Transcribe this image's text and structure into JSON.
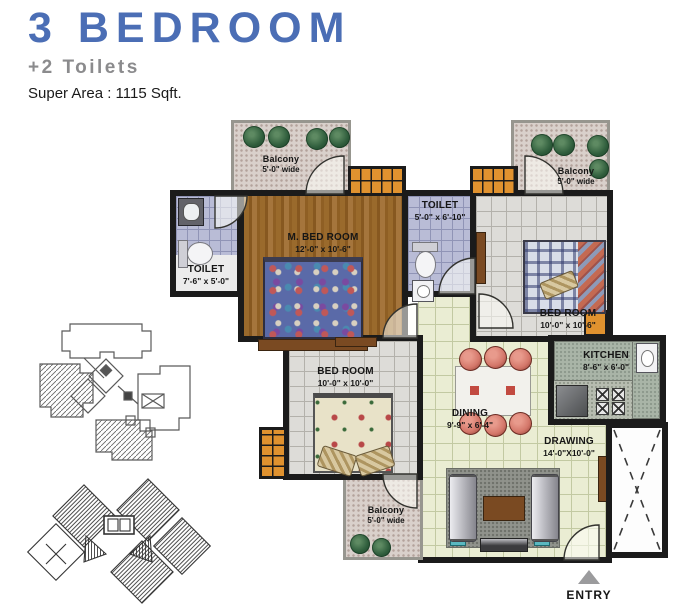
{
  "header": {
    "title": "3 BEDROOM",
    "subtitle": "+2 Toilets",
    "super_area": "Super Area : 1115 Sqft."
  },
  "rooms": {
    "balcony_tl": {
      "name": "Balcony",
      "dim": "5'-0\" wide"
    },
    "m_bedroom": {
      "name": "M. BED ROOM",
      "dim": "12'-0\" x 10'-6\""
    },
    "toilet_left": {
      "name": "TOILET",
      "dim": "7'-6\" x 5'-0\""
    },
    "toilet_mid": {
      "name": "TOILET",
      "dim": "5'-0\" x 6'-10\""
    },
    "balcony_tr": {
      "name": "Balcony",
      "dim": "5'-0\" wide"
    },
    "bedroom_right": {
      "name": "BED ROOM",
      "dim": "10'-0\" x 10'-6\""
    },
    "kitchen": {
      "name": "KITCHEN",
      "dim": "8'-6\" x 6'-0\""
    },
    "bedroom_bl": {
      "name": "BED ROOM",
      "dim": "10'-0\" x 10'-0\""
    },
    "dining": {
      "name": "DINING",
      "dim": "9'-9\" x 6'-4\""
    },
    "drawing": {
      "name": "DRAWING",
      "dim": "14'-0\"X10'-0\""
    },
    "balcony_b": {
      "name": "Balcony",
      "dim": "5'-0\" wide"
    }
  },
  "entry_label": "ENTRY",
  "colors": {
    "title_blue": "#4b6eb5",
    "subtitle_gray": "#8b8b8d",
    "wall_black": "#1b1b1b",
    "wardrobe_orange": "#e0922f",
    "wood_floor": "#9a6a2c",
    "toilet_tile": "#b9bcd6",
    "living_tile": "#eaedd3"
  }
}
